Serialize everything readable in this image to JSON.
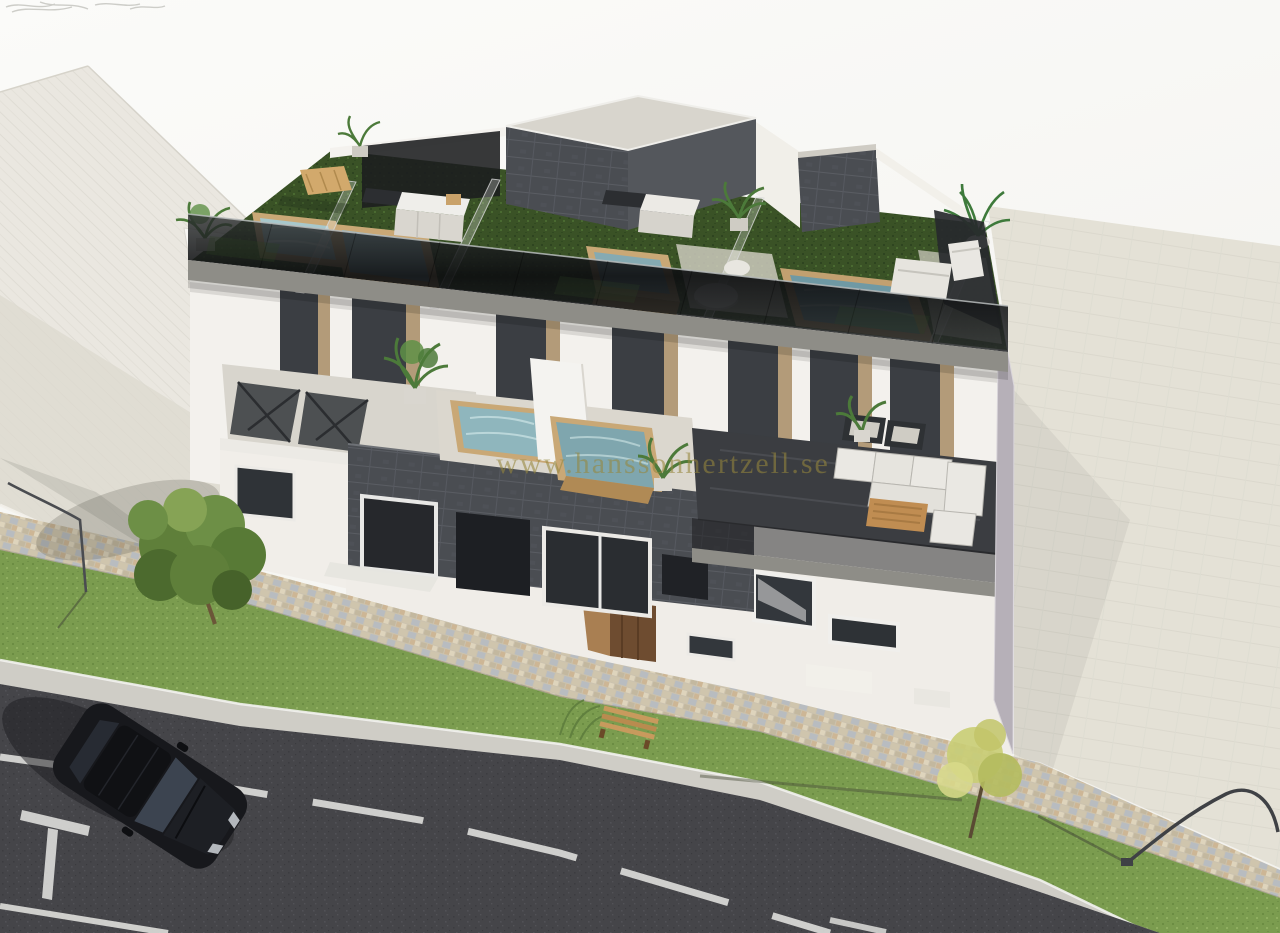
{
  "watermark": {
    "text": "www.hanssonhertzell.se"
  },
  "scene": {
    "description": "Aerial 3D architectural rendering of a modern two-storey apartment building with rooftop solarium terraces (artificial turf, glass balustrades, plunge pools, outdoor kitchens), middle-floor terraces with pools and lounge furniture, anthracite tiled accent volume, street with cobblestone sidewalk, lawn strip, asphalt road and a parked black car.",
    "objects": [
      "neighbor flat roof",
      "rooftop turf terraces",
      "glass balustrade",
      "jacuzzi pools",
      "outdoor kitchens",
      "roof access bulkheads",
      "sun loungers",
      "potted plants",
      "plunge pools",
      "outdoor sofa set",
      "coffee table",
      "entrance door",
      "anthracite tiled facade",
      "cobblestone sidewalk",
      "lawn strip",
      "asphalt road",
      "road markings",
      "black car",
      "green tree",
      "yellow tree",
      "wooden bench",
      "street lamps",
      "paved driveway"
    ]
  },
  "palette": {
    "sky": "#f7f6f3",
    "neighbor_roof": "#eae7e0",
    "neighbor_roof_line": "#dfdcd4",
    "driveway": "#e4e1d6",
    "cobble_base": "#cbc2ae",
    "lawn_base": "#7b9c4f",
    "curb": "#cfcdc6",
    "asphalt_base": "#454549",
    "road_marking": "#e8e8e4",
    "turf_base": "#3a5226",
    "glass_rail_dark": "#101113",
    "fascia": "#8e8d87",
    "facade_white": "#f3f1ed",
    "gable_left": "#f8f7f4",
    "gable_right": "#b6b0b8",
    "anthracite": "#4a4d52",
    "anthracite_line": "#5a5d63",
    "pool_water": "#7fa6ae",
    "pool_water_dark": "#6f99a4",
    "wood_deck": "#c9a876",
    "door_wood": "#6e4c30",
    "car_body": "#17181c",
    "tree_green": "#5f7f3a",
    "tree_yellow": "#c9cd74",
    "watermark_color": "rgba(150,134,60,0.58)"
  }
}
